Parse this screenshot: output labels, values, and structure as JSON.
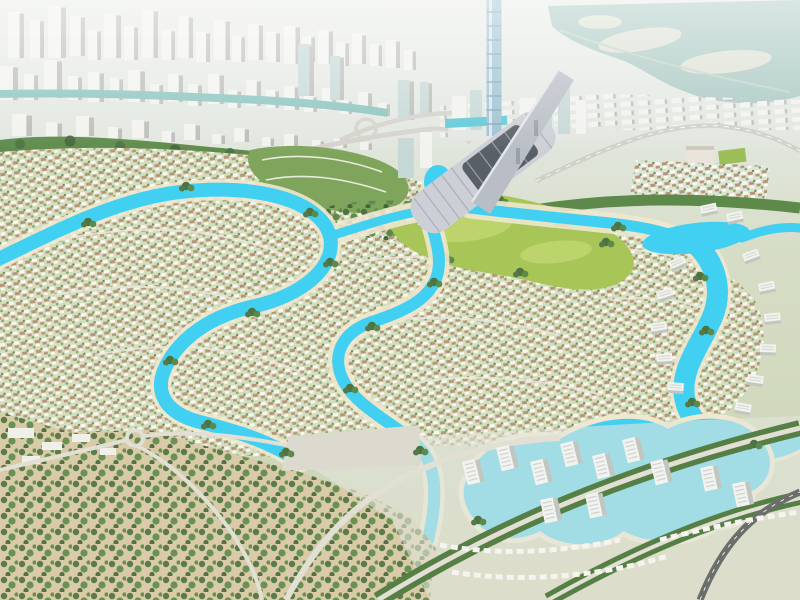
{
  "scene": {
    "type": "aerial-masterplan-rendering",
    "landmarks": {
      "skyline": "distant-city-skyline",
      "tower": "crystal-supertall-tower",
      "mall": "mall-with-ski-slope",
      "lagoon": "crystal-lagoon-network",
      "park": "central-golf-park",
      "villas": "villa-district",
      "apartments": "apartment-district",
      "forest": "desert-forest"
    }
  },
  "colors": {
    "haze": "#e9ece8",
    "distantGround": "#dfe3da",
    "distantWater": "#a9c8c2",
    "island": "#dce1d4",
    "city": "#f2f2ef",
    "cityShade": "#bcbdb8",
    "glass": "#c6d8d6",
    "canal": "#8cc4bf",
    "treeDark": "#4c7340",
    "treeMid": "#5d8a4a",
    "treeLight": "#7aa45e",
    "lagoon": "#41cff2",
    "lagoonEdge": "#efe8cf",
    "park": "#a8c557",
    "parkLight": "#bdd36c",
    "villaBase": "#d6dcc0",
    "villaRoof": "#b3916f",
    "villaWhite": "#fcfaf4",
    "street": "#eae7db",
    "sand": "#d9cba7",
    "tower": "#9ec2d2",
    "towerLine": "#7fa6bb",
    "mall": "#ccd0d6",
    "mallDark": "#585f66",
    "ramp": "#b9bec6",
    "road": "#e2dfd4",
    "asphalt": "#6a6f6b",
    "apt": "#f2f2ee",
    "aptShade": "#c3c6c0",
    "plaza": "#5fc9d6",
    "lawn": "#9cbe58"
  }
}
